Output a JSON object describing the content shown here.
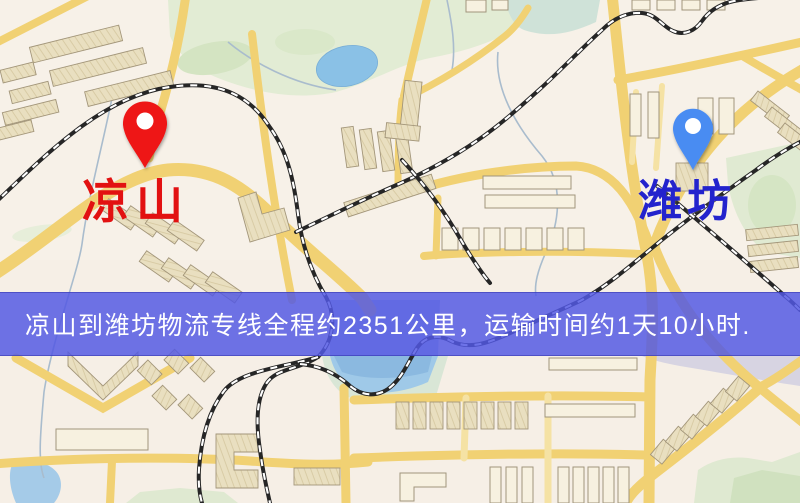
{
  "map": {
    "origin": {
      "label": "凉山",
      "pin": "red-pin",
      "pin_color": "#ee1212",
      "label_color": "#e21111"
    },
    "destination": {
      "label": "潍坊",
      "pin": "blue-pin",
      "pin_color": "#4a8cf2",
      "label_color": "#2323cd"
    },
    "banner": {
      "text": "凉山到潍坊物流专线全程约2351公里，运输时间约1天10小时.",
      "distance_km": "2351",
      "transit_time": "1天10小时",
      "background": "#5258e4",
      "text_color": "#ffffff"
    },
    "palette": {
      "background": "#f6efe6",
      "road": "#f1d173",
      "building": "#e9dfc0",
      "park": "#e2ecd4",
      "water": "#9fc9e8",
      "railway": "#262626"
    }
  }
}
